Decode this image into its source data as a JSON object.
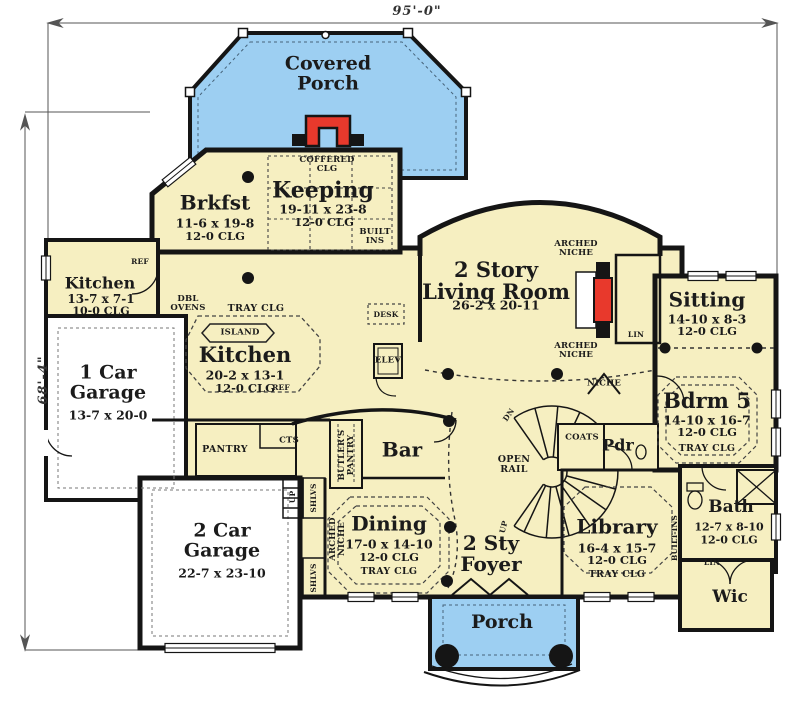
{
  "plan": {
    "dimensions": {
      "width": "95'-0\"",
      "height": "68'-4\""
    },
    "colors": {
      "floor": "#F6EFC1",
      "porch_blue": "#9DCFF2",
      "fireplace_red": "#E8392C",
      "wall": "#151515",
      "garage_fill": "#FFFFFF",
      "background": "#FFFFFF",
      "dim_line": "#555555"
    }
  },
  "rooms": {
    "covered_porch": {
      "name": "Covered\nPorch"
    },
    "brkfst": {
      "name": "Brkfst",
      "size": "11-6 x 19-8",
      "clg": "12-0 CLG"
    },
    "keeping": {
      "name": "Keeping",
      "size": "19-11 x 23-8",
      "clg": "12-0 CLG",
      "coffered": "COFFERED\nCLG",
      "built_ins": "BUILT\nINS"
    },
    "living": {
      "name": "2 Story\nLiving Room",
      "size": "26-2 x 20-11"
    },
    "sitting": {
      "name": "Sitting",
      "size": "14-10 x 8-3",
      "clg": "12-0 CLG"
    },
    "bdrm5": {
      "name": "Bdrm 5",
      "size": "14-10 x 16-7",
      "clg": "12-0 CLG",
      "tray": "TRAY CLG"
    },
    "kitchen_small": {
      "name": "Kitchen",
      "size": "13-7 x 7-1",
      "clg": "10-0 CLG"
    },
    "kitchen": {
      "name": "Kitchen",
      "size": "20-2 x 13-1",
      "clg": "12-0 CLG",
      "tray": "TRAY CLG",
      "island": "ISLAND",
      "dbl_ovens": "DBL\nOVENS"
    },
    "garage1": {
      "name": "1 Car\nGarage",
      "size": "13-7 x 20-0"
    },
    "garage2": {
      "name": "2 Car\nGarage",
      "size": "22-7 x 23-10"
    },
    "bar": {
      "name": "Bar"
    },
    "dining": {
      "name": "Dining",
      "size": "17-0 x 14-10",
      "clg": "12-0 CLG",
      "tray": "TRAY CLG"
    },
    "foyer": {
      "name": "2 Sty\nFoyer"
    },
    "library": {
      "name": "Library",
      "size": "16-4 x 15-7",
      "clg": "12-0 CLG",
      "tray": "TRAY CLG",
      "built_ins": "BUILT-INS"
    },
    "bath": {
      "name": "Bath",
      "size": "12-7 x 8-10",
      "clg": "12-0 CLG"
    },
    "wic": {
      "name": "Wic"
    },
    "pdr": {
      "name": "Pdr"
    },
    "porch": {
      "name": "Porch"
    }
  },
  "features": {
    "arched_niche": "ARCHED\nNICHE",
    "niche": "NICHE",
    "lin": "LIN",
    "coats": "COATS",
    "desk": "DESK",
    "elev": "ELEV",
    "ref": "REF",
    "pantry": "PANTRY",
    "cts": "CTS",
    "butlers_pantry": "BUTLER'S\nPANTRY",
    "shlvs": "SHLVS",
    "up": "UP",
    "dn": "DN",
    "open_rail": "OPEN\nRAIL"
  }
}
